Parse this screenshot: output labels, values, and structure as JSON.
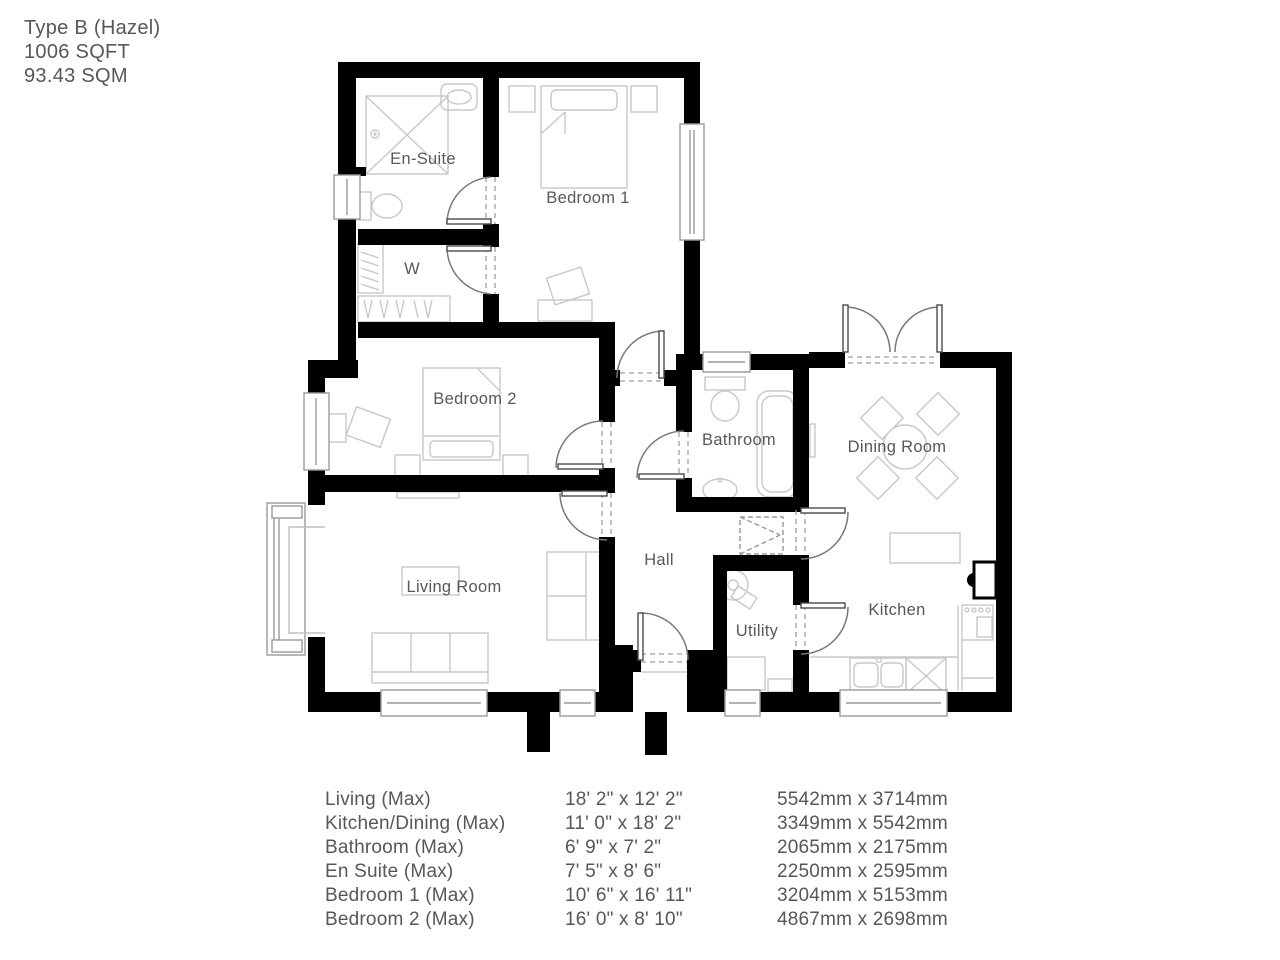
{
  "header": {
    "line1": "Type B (Hazel)",
    "line2": "1006 SQFT",
    "line3": "93.43 SQM"
  },
  "plan": {
    "rooms": {
      "ensuite": "En-Suite",
      "bedroom1": "Bedroom 1",
      "wardrobe": "W",
      "bedroom2": "Bedroom 2",
      "bathroom": "Bathroom",
      "dining": "Dining Room",
      "living": "Living Room",
      "hall": "Hall",
      "utility": "Utility",
      "kitchen": "Kitchen"
    }
  },
  "dimensions": {
    "rows": [
      {
        "room": "Living (Max)",
        "imperial": "18' 2\" x 12' 2\"",
        "metric": "5542mm x 3714mm"
      },
      {
        "room": "Kitchen/Dining (Max)",
        "imperial": "11' 0\" x 18' 2\"",
        "metric": "3349mm x 5542mm"
      },
      {
        "room": "Bathroom (Max)",
        "imperial": "6' 9\" x 7' 2\"",
        "metric": "2065mm x 2175mm"
      },
      {
        "room": "En Suite (Max)",
        "imperial": "7' 5\" x 8' 6\"",
        "metric": "2250mm x 2595mm"
      },
      {
        "room": "Bedroom 1 (Max)",
        "imperial": "10' 6\" x 16' 11\"",
        "metric": "3204mm x 5153mm"
      },
      {
        "room": "Bedroom 2 (Max)",
        "imperial": "16' 0\" x 8' 10\"",
        "metric": "4867mm x 2698mm"
      }
    ]
  },
  "colors": {
    "wall": "#000000",
    "text": "#58585a",
    "furniture": "#c7c8ca",
    "door_arc": "#787878",
    "window_frame": "#9a9a9a"
  }
}
